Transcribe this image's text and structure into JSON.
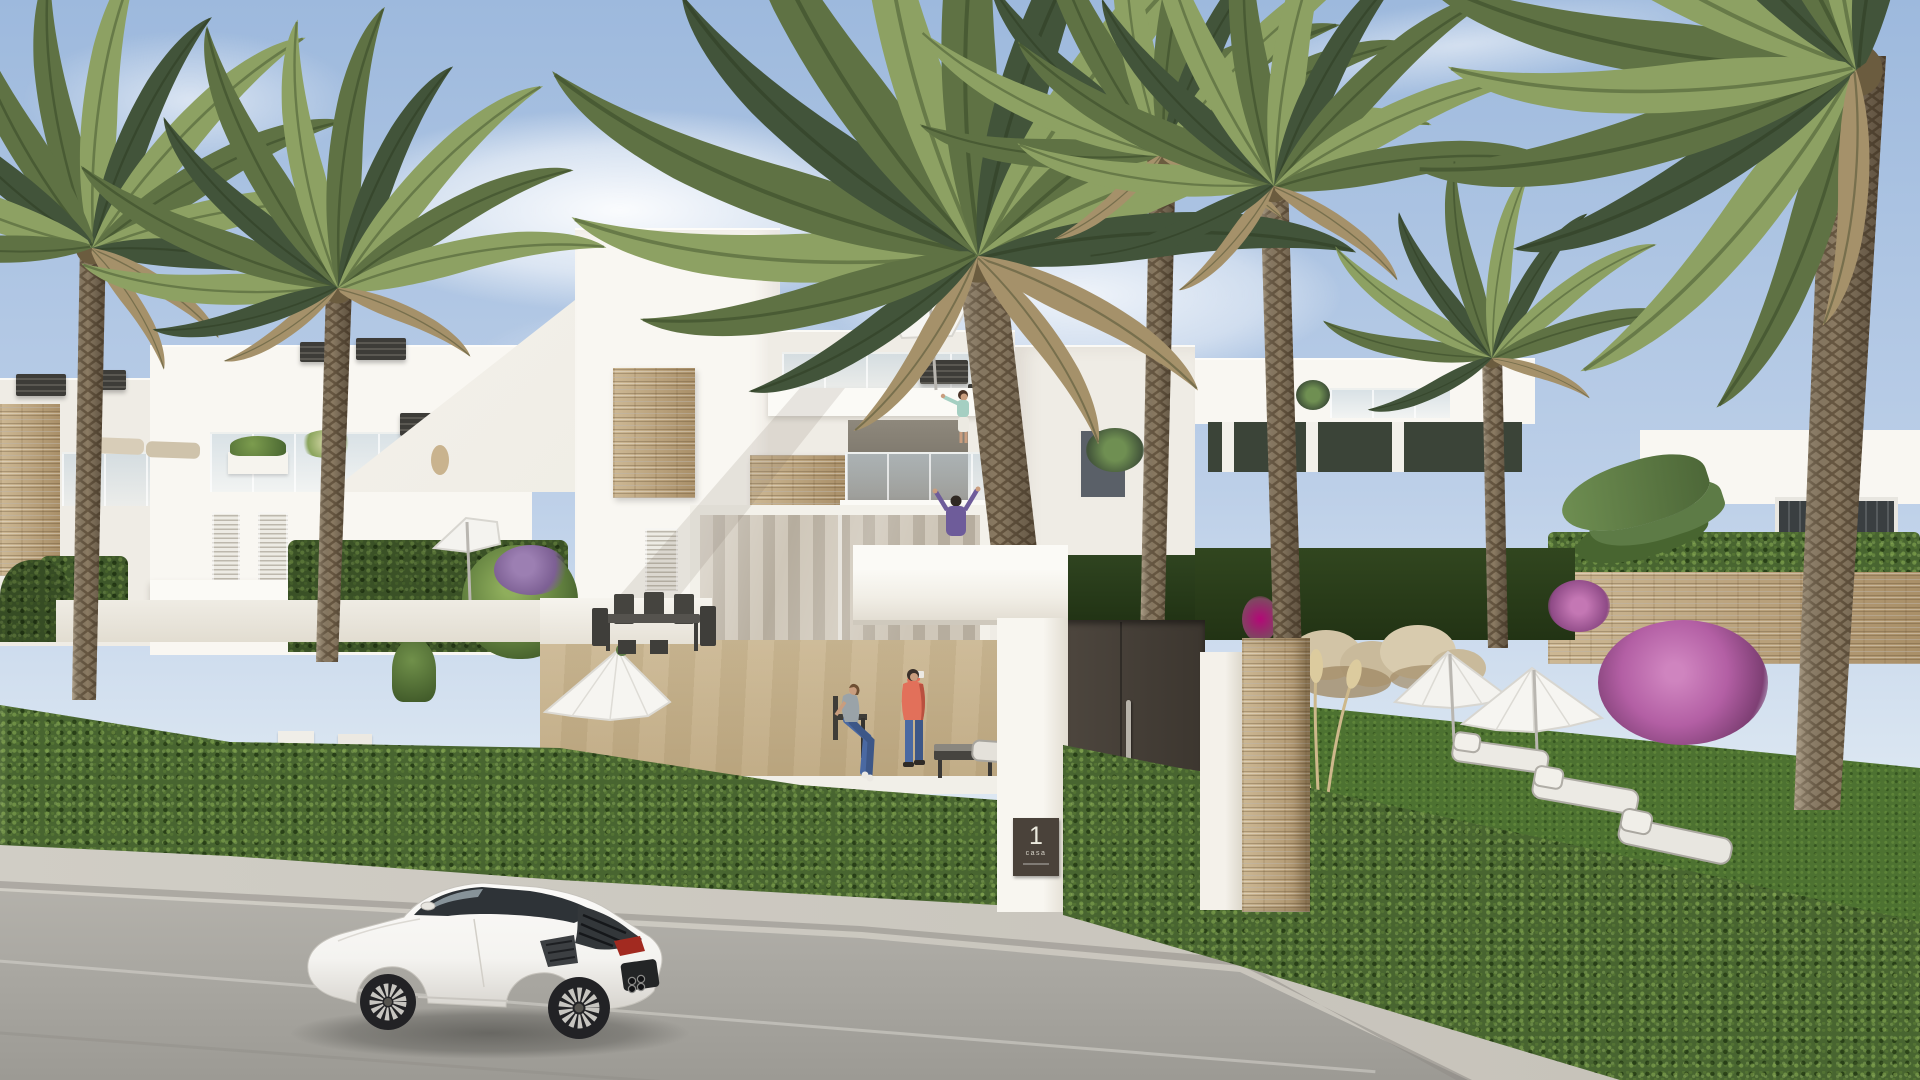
{
  "scene": {
    "type": "photorealistic architectural render",
    "description": "Street view of a new-build white Mediterranean residential development: two-storey townhouses with roof terraces, tall date palms, trimmed green hedges, a gated entrance marked 1, landscaped garden with parasols and sun loungers, and a white sports coupe parked on the road.",
    "sky": "clear light-blue sky with thin white clouds",
    "time_of_day": "bright daylight"
  },
  "entrance": {
    "plaque_number": "1",
    "plaque_label": "casa"
  },
  "objects": {
    "car": "white Lamborghini-style coupe, rear three-quarter view, facing left",
    "people": [
      "woman pointing on the rooftop terrace",
      "man with raised arms on the first-floor balcony",
      "man in a coral jacket taking a photo on the patio",
      "woman seated at the patio table"
    ],
    "vegetation": [
      "date palm trees",
      "clipped green hedges",
      "lawn",
      "pampas grass",
      "purple bougainvillea",
      "lavender",
      "tropical shrubs"
    ],
    "furniture": [
      "outdoor dining set",
      "sun loungers",
      "white parasols",
      "chaise longue",
      "low coffee table"
    ],
    "architecture": [
      "white two-storey townhouses",
      "glass balcony railings",
      "louvred shutters",
      "stacked-stone feature walls",
      "roof terraces",
      "slatted chimney caps",
      "anthracite entrance gate",
      "stone gate pillar"
    ]
  },
  "palette": {
    "skyTop": "#9db9dd",
    "skyMid": "#bccfe8",
    "skyLow": "#dce7f2",
    "cloud": "#ffffff",
    "wall": "#efece5",
    "wallBright": "#f9f7f2",
    "wallShade": "#ddd7cc",
    "wallDark": "#c9c2b5",
    "stoneA": "#cdb894",
    "stoneB": "#a98f68",
    "louver": "#edebe4",
    "louverLine": "#bdb8ad",
    "glass": "#c5d4de",
    "cap": "#3d3c38",
    "hedge": "#486530",
    "hedgeLight": "#7c9c4e",
    "hedgeDark": "#22380f",
    "lawn": "#4d7231",
    "frond": "#5f7244",
    "frondLight": "#8da163",
    "frondDark": "#42543a",
    "deadFrond": "#a5916a",
    "bark": "#8b7b63",
    "barkDark": "#675741",
    "road": "#aaa8a2",
    "roadLight": "#bcb9b2",
    "sidewalk": "#d0cdc5",
    "curb": "#908d86",
    "gate": "#4d463e",
    "gateDark": "#3c362f",
    "plaque": "#4a423a",
    "plaqueText": "#eceade",
    "carBody": "#f4f3f0",
    "carShade": "#d7d4ce",
    "carWindow": "#2e3337",
    "tire": "#222225",
    "rim": "#c7c5c0",
    "tail": "#a22a20",
    "skin": "#c99d7e",
    "coral": "#e2705a",
    "jeans": "#4a69a2",
    "teal": "#a5cfc2",
    "purple": "#6e5c9a",
    "grayTop": "#9aa3a8",
    "hair": "#3a302a",
    "patio": "#dccfb5",
    "patioLight": "#ece3d0",
    "rock": "#c9ba9b",
    "rockShade": "#a38c68",
    "bougain": "#b35fa4",
    "lavender": "#9c7fb2",
    "pampas": "#cdb88b"
  }
}
